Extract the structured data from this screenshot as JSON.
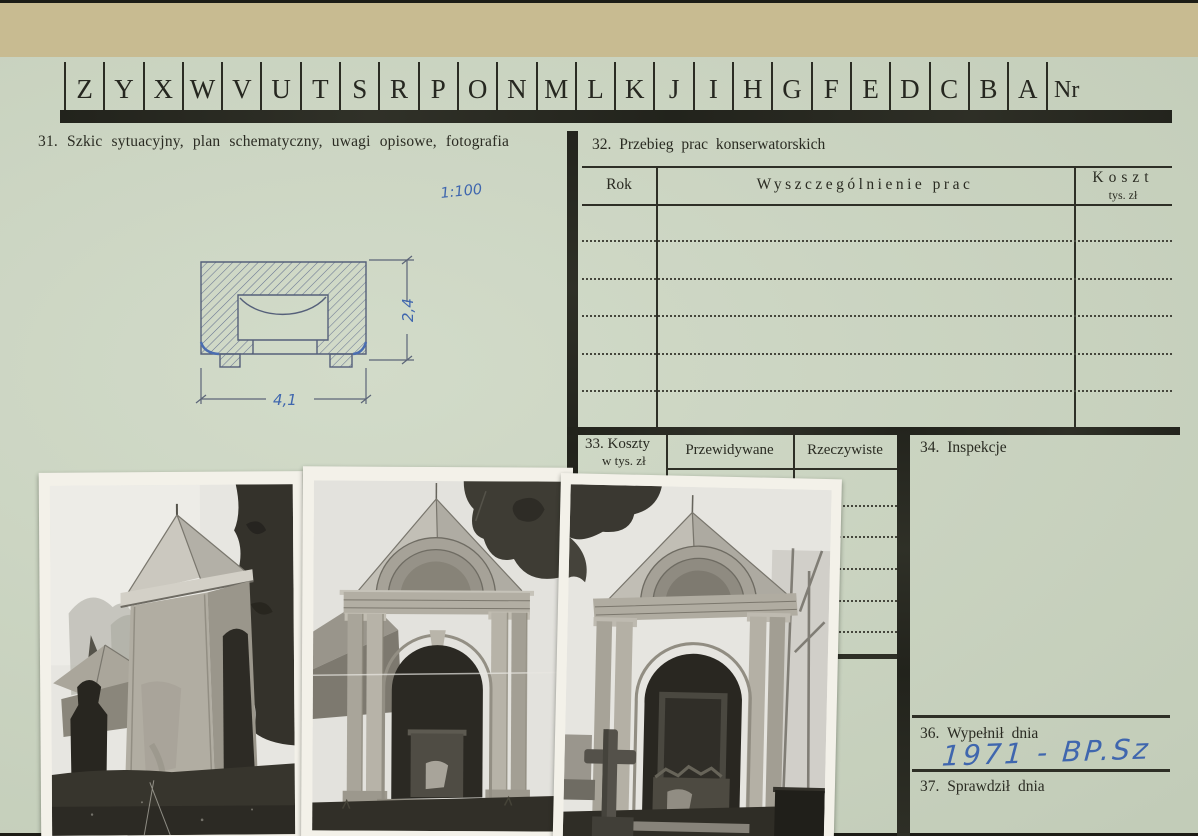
{
  "palette": {
    "backing_tan": "#c8bb91",
    "card_green": "#cdd7c3",
    "ink_dark": "#2a2b22",
    "handwriting_blue": "#3f66ae",
    "pencil_gray_blue": "#5c6578"
  },
  "tabs": {
    "letters": [
      "Z",
      "Y",
      "X",
      "W",
      "V",
      "U",
      "T",
      "S",
      "R",
      "P",
      "O",
      "N",
      "M",
      "L",
      "K",
      "J",
      "I",
      "H",
      "G",
      "F",
      "E",
      "D",
      "C",
      "B",
      "A"
    ],
    "nr": "Nr"
  },
  "section31": {
    "title": "31. Szkic sytuacyjny, plan schematyczny, uwagi opisowe, fotografia",
    "sketch": {
      "scale": "1:100",
      "width_dim": "4,1",
      "height_dim": "2,4"
    }
  },
  "section32": {
    "title": "32. Przebieg prac konserwatorskich",
    "col_rok": "Rok",
    "col_prace": "Wyszczególnienie prac",
    "col_koszt": "Koszt",
    "col_koszt_sub": "tys. zł",
    "empty_rows": 5
  },
  "section33": {
    "title_line1": "33. Koszty",
    "title_line2": "w tys. zł",
    "col_przewidywane": "Przewidywane",
    "col_rzeczywiste": "Rzeczywiste",
    "empty_rows": 5
  },
  "section34": {
    "title": "34. Inspekcje"
  },
  "section36": {
    "title": "36. Wypełnił dnia",
    "handwritten_entry": "1971 - BP.Sz"
  },
  "section37": {
    "title": "37. Sprawdził dnia"
  },
  "photos": [
    {
      "label": "black-and-white photograph: corner chapel with pyramidal sheet-metal roof seen from the side, tall tree on the right, statue silhouette at left"
    },
    {
      "label": "black-and-white photograph: front view of the chapel with arched pediment, paired columns and dark arched niche"
    },
    {
      "label": "black-and-white photograph: angled view of the chapel with a stone cross in front and bare trees behind"
    }
  ]
}
